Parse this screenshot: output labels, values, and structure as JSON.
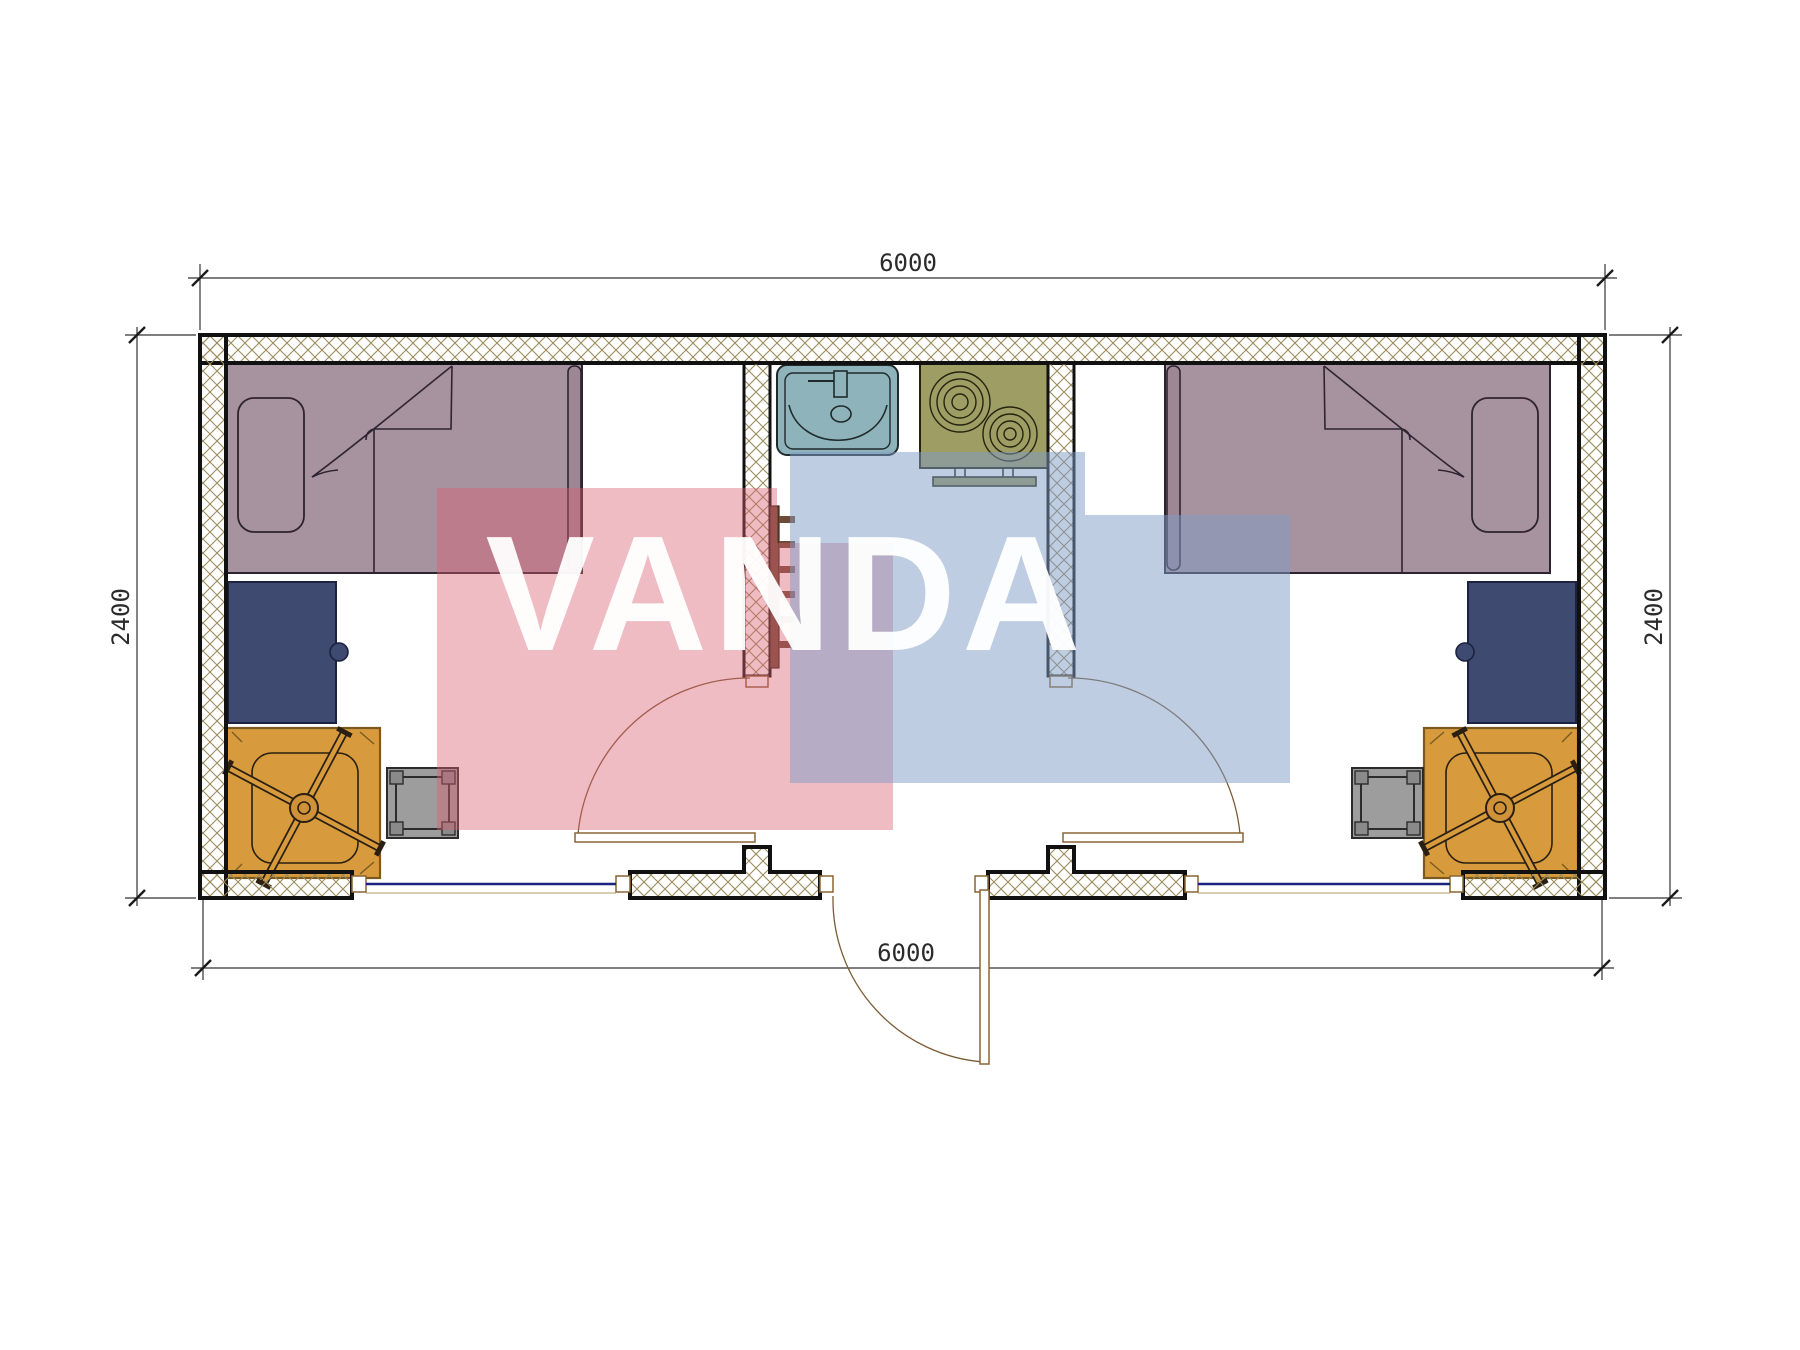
{
  "page": {
    "background": "#ffffff",
    "type": "architectural-floor-plan"
  },
  "watermark": {
    "text": "VANDA",
    "red_block_color": "#d95f73",
    "blue_block_color": "#7f9cc5",
    "text_color": "#ffffff"
  },
  "dimensions": {
    "top": "6000",
    "bottom": "6000",
    "left": "2400",
    "right": "2400"
  },
  "plan": {
    "colors": {
      "wall_hatch": "#9b8b5c",
      "wall_outline": "#111111",
      "bed": "#a7929f",
      "bed_rail": "#9d8795",
      "desk": "#3e4a70",
      "mat": "#d79b3e",
      "stool": "#9d9d9d",
      "sink": "#8fb3ba",
      "stove": "#9e9d64",
      "heater": "#6e4a38",
      "window_glass": "#1a237e",
      "door_frame": "#8a6434",
      "dimension_line": "#333333"
    },
    "rooms": [
      {
        "name": "left-bedroom",
        "furniture": [
          "single-bed",
          "pillow",
          "desk",
          "office-chair",
          "rug",
          "stool"
        ]
      },
      {
        "name": "kitchen-core",
        "furniture": [
          "sink",
          "two-burner-cooktop",
          "ladder-heater"
        ]
      },
      {
        "name": "right-bedroom",
        "furniture": [
          "single-bed",
          "pillow",
          "desk",
          "office-chair",
          "rug",
          "stool"
        ]
      }
    ],
    "openings": [
      "left-room-interior-door",
      "right-room-interior-door",
      "entrance-door",
      "window-left",
      "window-right"
    ]
  }
}
